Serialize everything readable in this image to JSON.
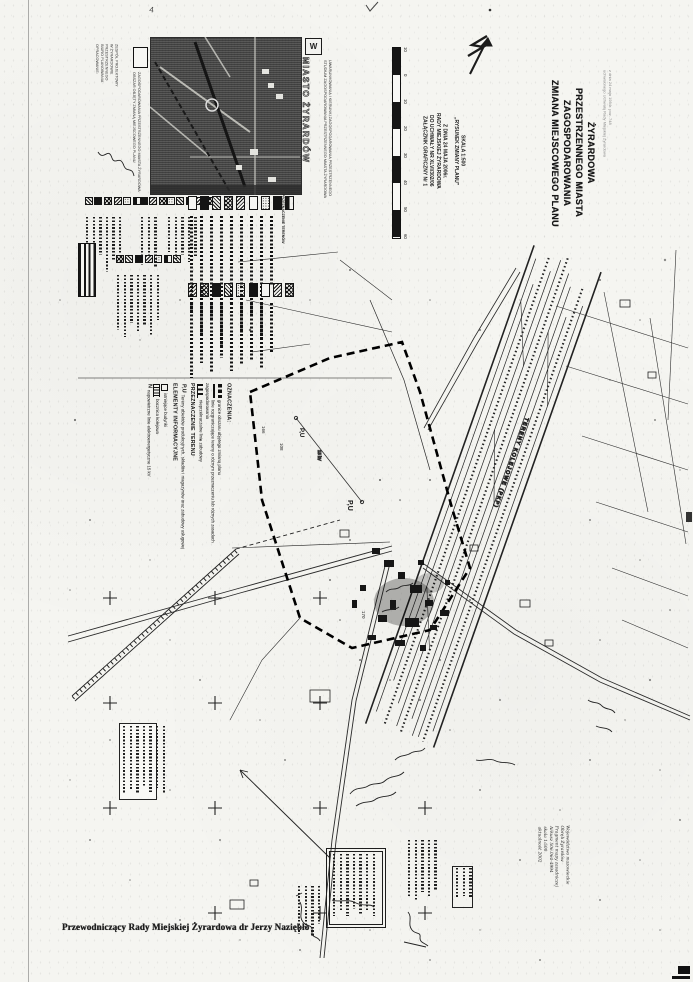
{
  "document": {
    "bottom_caption": "Przewodniczący Rady Miejskiej Żyrardowa dr Jerzy Naziębło"
  },
  "title_block": {
    "lines": [
      "ZMIANA MIEJSCOWEGO  PLANU",
      "ZAGOSPODAROWANIA",
      "PRZESTRZENNEGO MIASTA",
      "ŻYRARDOWA"
    ],
    "note_lines": [
      "uchwalonego Uchwałą Rady Miejskiej Żyrardowa",
      "z dnia 24 maja 1994r. poz. 748"
    ]
  },
  "annex_block": {
    "lines": [
      "ZAŁĄCZNIK GRAFICZNY Nr 1",
      "DO UCHWAŁY NR XLVI/302/06",
      "RADY MIEJSKIEJ ŻYRARDOWA",
      "Z DNIA 24 MAJA 2006r."
    ],
    "subtitle": "„RYSUNEK ZMIANY PLANU”",
    "scale": "SKALA 1:500"
  },
  "scalebar": {
    "ticks": [
      "10",
      "0",
      "10",
      "20",
      "30",
      "40",
      "50",
      "60"
    ]
  },
  "inset": {
    "city_label": "MIASTO ŻYRARDÓW",
    "crest_glyph": "W",
    "side_caption_lines": [
      "STUDIUM ZAGOSPODAROWANIA PRZESTRZENNEGO MIASTA ŻYRARDOWA",
      "UWARUNKOWANIA I KIERUNKI ZAGOSPODAROWANIA PRZESTRZENNEGO"
    ],
    "credit_lines": [
      "OPRACOWANIE:",
      "BIURO PLANOWANIA",
      "PRZESTRZENNEGO",
      "W ŻYRARDOWIE",
      "ZESPÓŁ PROJEKTOWY"
    ],
    "symbol_caption_lines": [
      "OBSZAR OBJĘTY ZMIANĄ MIEJSCOWEGO PLANU",
      "ZAGOSPODAROWANIA PRZESTRZENNEGO MIASTA ŻYRARDOWA"
    ]
  },
  "legend": {
    "big_header": "PRZEZNACZENIE TERENÓW"
  },
  "oznaczenia": {
    "header": "OZNACZENIA:",
    "items": [
      {
        "symbol": "bold-dash-line",
        "label": "granice obszaru objętego zmianą planu"
      },
      {
        "symbol": "solid-line",
        "label": "linie rozgraniczające tereny o różnym przeznaczeniu lub różnych zasadach zagospodarowania"
      },
      {
        "symbol": "triangle-line",
        "label": "nieprzekraczalne linie zabudowy"
      }
    ],
    "section2": "PRZEZNACZENIE TERENU",
    "pu_symbol": "P,U",
    "pu_label": "Tereny obiektów produkcyjnych, składów i magazynów oraz zabudowy usługowej",
    "section3": "ELEMENTY INFORMACYJNE",
    "info_items": [
      {
        "symbol": "small-square",
        "label": "istniejące budynki"
      },
      {
        "symbol": "track",
        "label": "bocznica kolejowa"
      },
      {
        "symbol": "N",
        "label": "napowietrzne linie elektroenergetyczne 15 kV"
      }
    ]
  },
  "map": {
    "railway_label": "TERENY KOLEJOWE (PKP)",
    "zone_labels": [
      "P,U",
      "P,U"
    ],
    "parcel_numbers": [
      "108",
      "166",
      "170"
    ],
    "power_line_label": "15 kV",
    "corner_mark": "4"
  },
  "metadata_block": {
    "lines": [
      "Województwo mazowieckie",
      "Obręb Żyrardów",
      "Fragment mapy zasadniczej",
      "Arkusz 506.064-4994",
      "skala 1:500",
      "aktualność 2002"
    ]
  },
  "colors": {
    "ink": "#1c1c1c",
    "paper": "#f5f5f1",
    "halftone": "#4a4a4a",
    "faint": "#8a8a8a"
  }
}
